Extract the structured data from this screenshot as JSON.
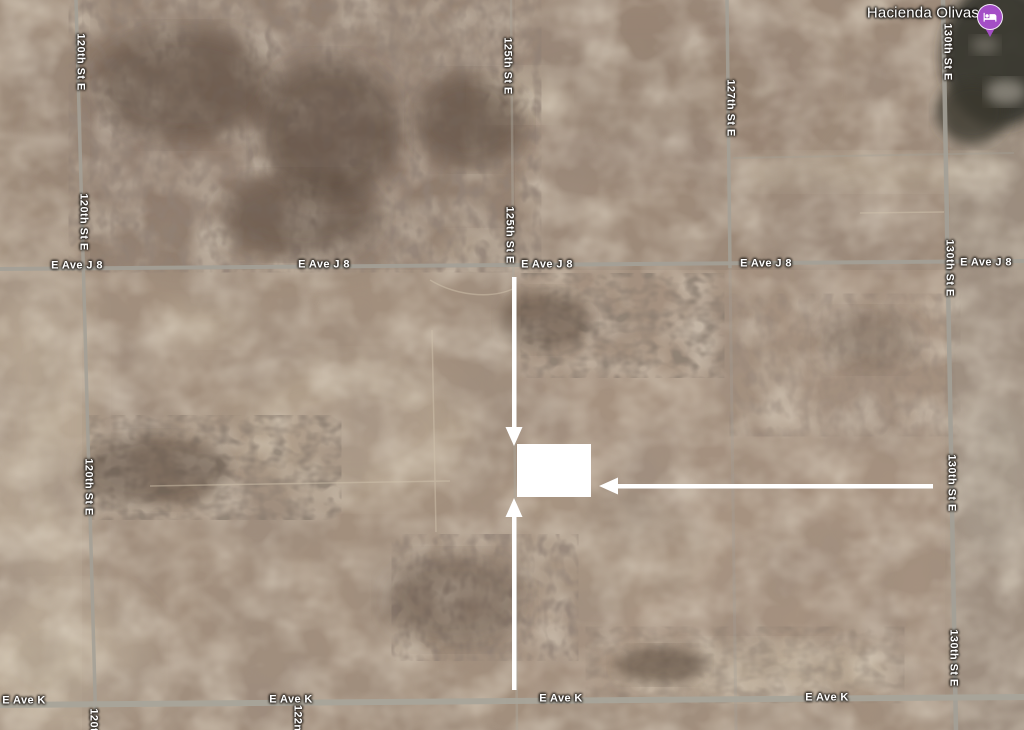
{
  "map": {
    "place_marker": {
      "name": "Hacienda Olivas",
      "color": "#a44fc6",
      "icon": "lodging-icon"
    },
    "road_labels": {
      "st_120": "120th St E",
      "st_122": "122nd St E",
      "st_125": "125th St E",
      "st_127": "127th St E",
      "st_130": "130th St E",
      "ave_j8": "E Ave J 8",
      "ave_k": "E Ave K"
    },
    "colors": {
      "terrain_base": "#a28f7d",
      "road_line": "#a3a097",
      "label_text": "#ffffff",
      "annotation": "#ffffff",
      "vegetation_dark": "#32302a"
    }
  }
}
